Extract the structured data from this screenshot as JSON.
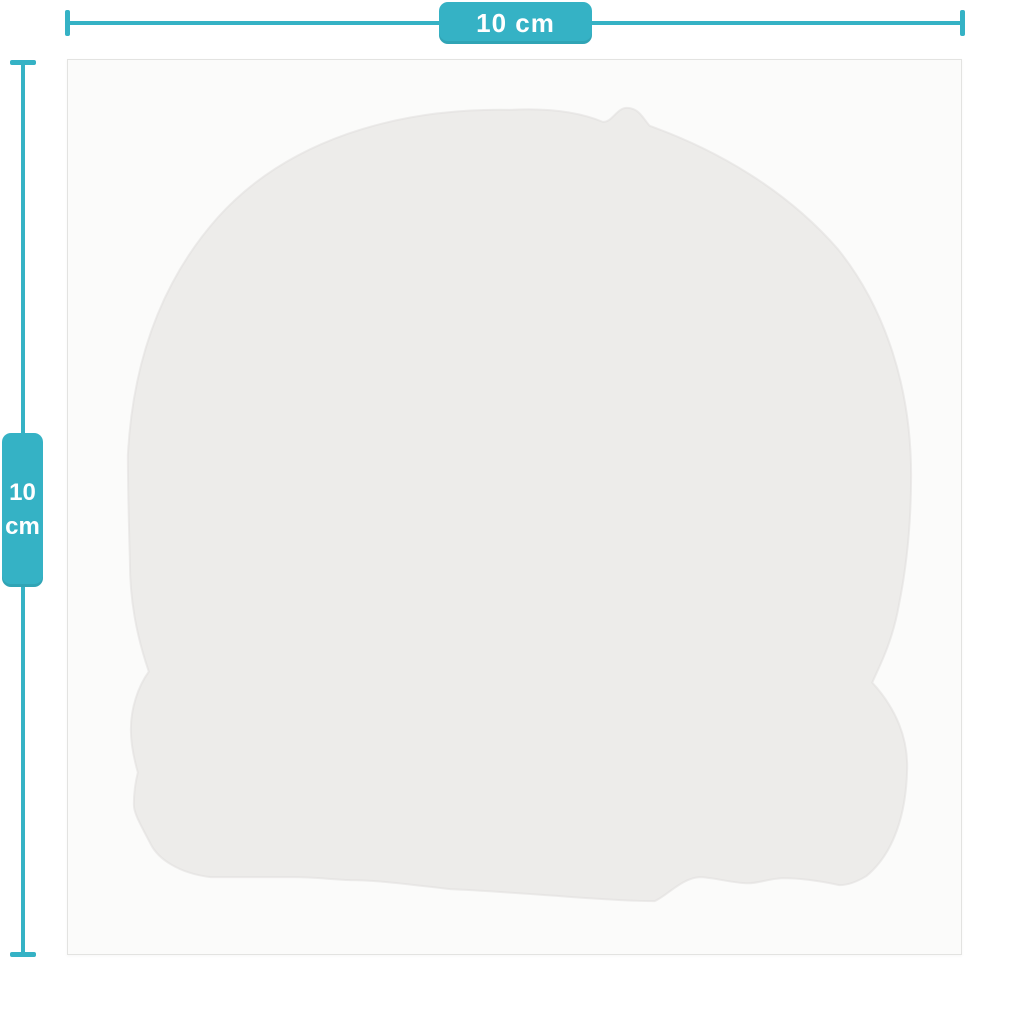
{
  "meta": {
    "type": "product-dimension-diagram",
    "subject": "die-cut sticker silhouette on square backing sheet"
  },
  "colors": {
    "page_bg": "#ffffff",
    "accent_teal": "#35b2c5",
    "label_text": "#ffffff",
    "card_bg": "#fbfbfa",
    "card_border": "#e3e3e1",
    "sticker_fill": "#edecea",
    "sticker_edge": "#e0dfdc"
  },
  "measurements": {
    "width": {
      "label": "10 cm"
    },
    "height": {
      "value": "10",
      "unit": "cm"
    }
  }
}
